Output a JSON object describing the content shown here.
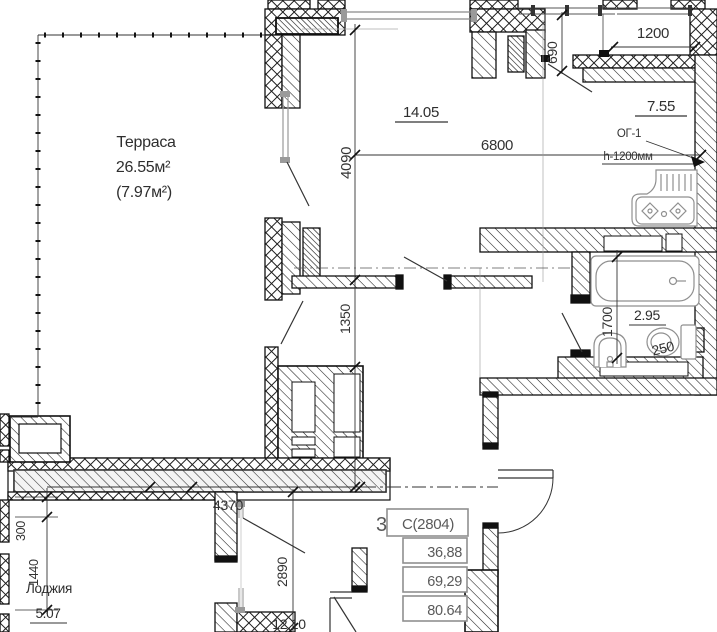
{
  "rooms": {
    "terrace": {
      "name": "Терраса",
      "area": "26.55м²",
      "area_alt": "(7.97м²)"
    },
    "living": {
      "area": "14.05"
    },
    "kitchen": {
      "area": "7.55"
    },
    "bathroom": {
      "area": "2.95"
    },
    "loggia": {
      "name": "Лоджия",
      "area": "5.07"
    },
    "bedroom": {
      "area": "12.10"
    }
  },
  "dimensions": {
    "d690": "690",
    "d1200": "1200",
    "d4090": "4090",
    "d6800": "6800",
    "d1350": "1350",
    "d1700": "1700",
    "d250": "250",
    "d300": "300",
    "d1440": "1440",
    "d4370": "4370",
    "d2890": "2890"
  },
  "annotations": {
    "window_type": "ОГ-1",
    "window_height": "h-1200мм"
  },
  "info_table": {
    "prefix": "3",
    "unit": "С(2804)",
    "living_area": "36,88",
    "area": "69,29",
    "total_area": "80.64"
  },
  "colors": {
    "wall_line": "#111111",
    "highlight_gray": "#b5b5b5",
    "fixture_gray": "#8f8f8f",
    "table_gray": "#8f8f8f"
  }
}
